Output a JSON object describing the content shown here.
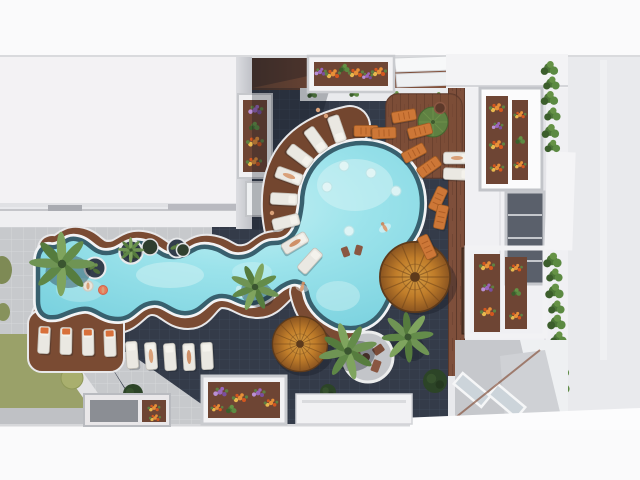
{
  "scene": {
    "description": "Aerial top-down 3D rendering of a resort courtyard: a freeform turquoise lazy-river pool with a large circular lounge pool, wooden decks, radial sun loungers, thatched parasols, palm trees and flower planters between white apartment buildings",
    "time_of_day": "day",
    "view": "top-down aerial"
  },
  "objects": {
    "pool": {
      "shape": "freeform with circular bulge and lower lobe",
      "swimmers": 5
    },
    "palm_trees": 5,
    "thatched_umbrellas": 2,
    "sun_loungers_white": 17,
    "sun_loungers_orange": 9,
    "circular_pool_islands": 3,
    "flower_planters": 7,
    "hedge_bushes_column": 16,
    "grass_circles": 2,
    "dark_shrub_circles": 3,
    "buildings": [
      "left white roof block",
      "right balcony building",
      "top band building",
      "bottom band building"
    ]
  },
  "palette": {
    "ground": "#e8e9ec",
    "band": "#fafafb",
    "roof": "#f3f2f4",
    "building": "#f0f0f3",
    "tile_dark": "#343b49",
    "tile_dark_line": "#404a5a",
    "tile_light": "#c7c9cc",
    "wood": "#7a4b33",
    "wood_dark": "#5d392a",
    "water": "#92dce7",
    "water_light": "#c6f0f3",
    "pool_rim": "#f2f3f5",
    "pool_edge": "#38606e",
    "lawn": "#9aa169",
    "grass_circle": "#a9af6e",
    "bush": "#4d7638",
    "bush_dark": "#2c4427",
    "thatch_light": "#d9a044",
    "thatch_dark": "#8a5420",
    "lounger_white": "#eae8e2",
    "lounger_orange": "#cd7737",
    "towel_orange": "#d8703a",
    "flower_orange": "#e89038",
    "flower_red": "#d4571f",
    "flower_purple": "#9a67bd",
    "flower_yellow": "#e8b84e",
    "window": "#5a606b",
    "skin": "#d9a078"
  }
}
